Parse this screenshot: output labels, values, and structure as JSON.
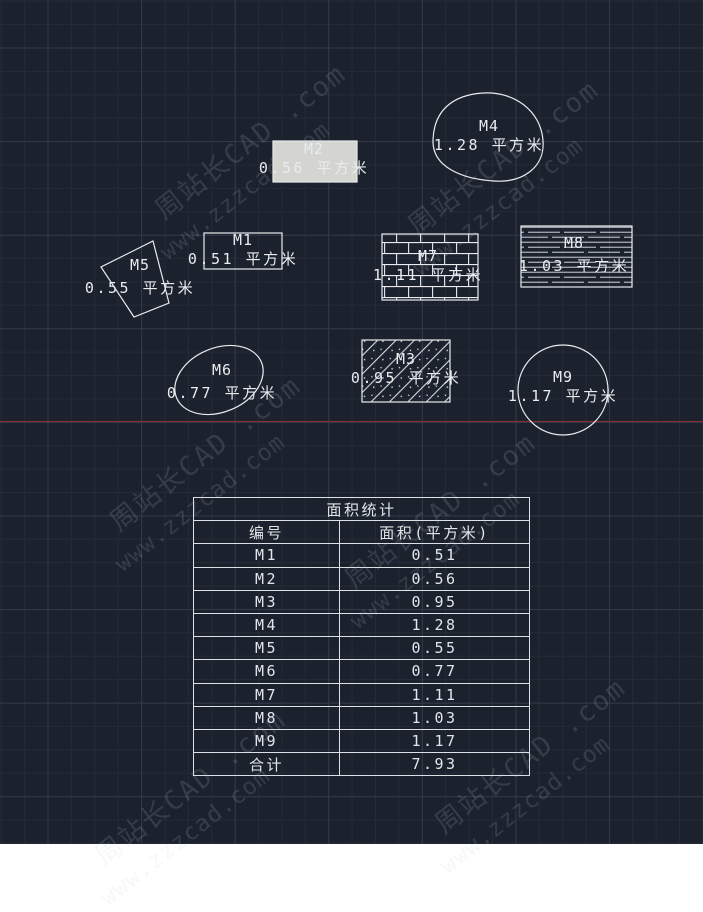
{
  "app": {
    "type": "cad-drawing-canvas"
  },
  "colors": {
    "background": "#1b212d",
    "grid_minor": "#242b38",
    "grid_major": "#323a4a",
    "axis_line_red": "#7d3236",
    "shape_stroke": "#e9ebee",
    "m2_fill": "#d4d5d1",
    "text": "#e9ecef"
  },
  "watermark": {
    "line1": "周站长CAD .com",
    "line2": "www.zzzcad.com"
  },
  "shapes": [
    {
      "id": "M1",
      "type": "rectangle-outline",
      "area_text": "0.51 平方米"
    },
    {
      "id": "M2",
      "type": "rectangle-solid-fill",
      "area_text": "0.56 平方米"
    },
    {
      "id": "M3",
      "type": "rectangle-diagonal-hatch",
      "area_text": "0.95 平方米"
    },
    {
      "id": "M4",
      "type": "closed-spline-blob",
      "area_text": "1.28 平方米"
    },
    {
      "id": "M5",
      "type": "rotated-quadrilateral",
      "area_text": "0.55 平方米"
    },
    {
      "id": "M6",
      "type": "tilted-ellipse",
      "area_text": "0.77 平方米"
    },
    {
      "id": "M7",
      "type": "rectangle-brick-hatch",
      "area_text": "1.11 平方米"
    },
    {
      "id": "M8",
      "type": "rectangle-line-hatch",
      "area_text": "1.03 平方米"
    },
    {
      "id": "M9",
      "type": "circle",
      "area_text": "1.17 平方米"
    }
  ],
  "table": {
    "title": "面积统计",
    "columns": [
      "编号",
      "面积(平方米)"
    ],
    "rows": [
      [
        "M1",
        "0.51"
      ],
      [
        "M2",
        "0.56"
      ],
      [
        "M3",
        "0.95"
      ],
      [
        "M4",
        "1.28"
      ],
      [
        "M5",
        "0.55"
      ],
      [
        "M6",
        "0.77"
      ],
      [
        "M7",
        "1.11"
      ],
      [
        "M8",
        "1.03"
      ],
      [
        "M9",
        "1.17"
      ],
      [
        "合计",
        "7.93"
      ]
    ]
  }
}
